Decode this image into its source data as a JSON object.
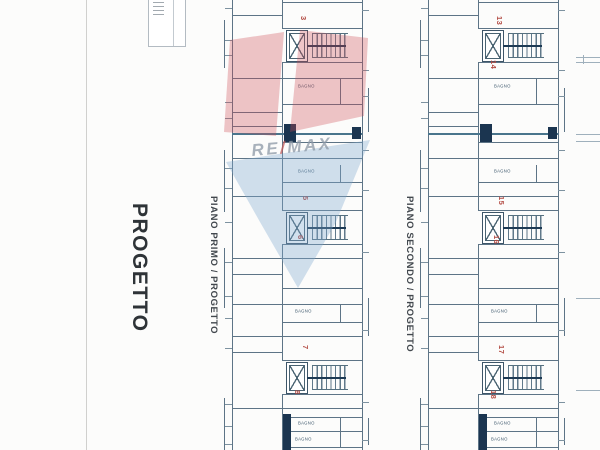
{
  "sheet": {
    "side_label": "PROGETTO"
  },
  "watermark": {
    "re": "RE",
    "slash": "/",
    "max": "MAX",
    "red": "#cc4a55",
    "blue": "#7fa8d0"
  },
  "plans": [
    {
      "label": "PIANO PRIMO / PROGETTO",
      "bathroom_labels": [
        "BAGNO",
        "BAGNO",
        "BAGNO",
        "BAGNO",
        "BAGNO"
      ],
      "unit_numbers": {
        "top_a": "3",
        "top_b": "",
        "mid_a": "5",
        "mid_b": "6",
        "bot_a": "7",
        "bot_b": "8"
      }
    },
    {
      "label": "PIANO SECONDO / PROGETTO",
      "bathroom_labels": [
        "BAGNO",
        "BAGNO",
        "BAGNO",
        "BAGNO",
        "BAGNO"
      ],
      "unit_numbers": {
        "top_a": "13",
        "top_b": "14",
        "mid_a": "15",
        "mid_b": "16",
        "bot_a": "17",
        "bot_b": "18"
      }
    }
  ]
}
